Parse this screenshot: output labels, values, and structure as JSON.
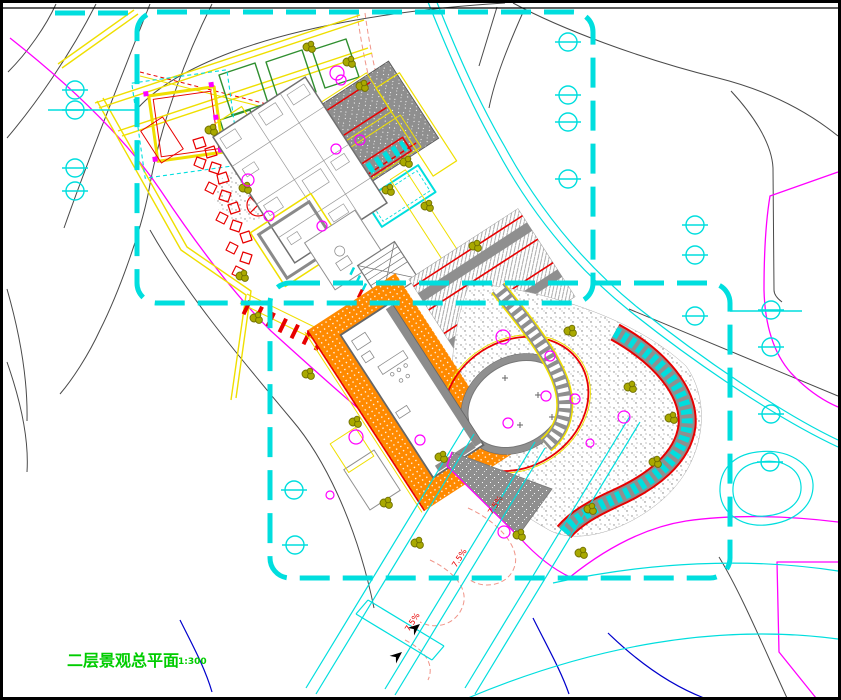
{
  "drawing": {
    "title": "二层景观总平面",
    "scale": "1:300",
    "slope_labels": [
      "7.5%",
      "7.5%",
      "7.5%"
    ]
  },
  "colors": {
    "cyan": "#00DEDE",
    "magenta": "#FF00FF",
    "yellow": "#EFDF00",
    "orange": "#FF8A00",
    "red": "#E80000",
    "salmon": "#F09488",
    "olive": "#A9A900",
    "green_bed": "#2F8F2F",
    "title_green": "#00CC00",
    "blue": "#0000CC",
    "gray_line": "#4A4A4A",
    "gray_fill": "#8F8F8F",
    "frame": "#000000",
    "paper": "#FFFFFF"
  },
  "symbols": {
    "boundary": "cyan-dashed-property-line",
    "tree_circle": "deciduous-tree-symbol",
    "shrub": "olive-shrub-symbol",
    "flowering_tree": "magenta-tree-symbol",
    "rock": "red-rockery-stone",
    "slope_arrow": "black-slope-arrow"
  }
}
